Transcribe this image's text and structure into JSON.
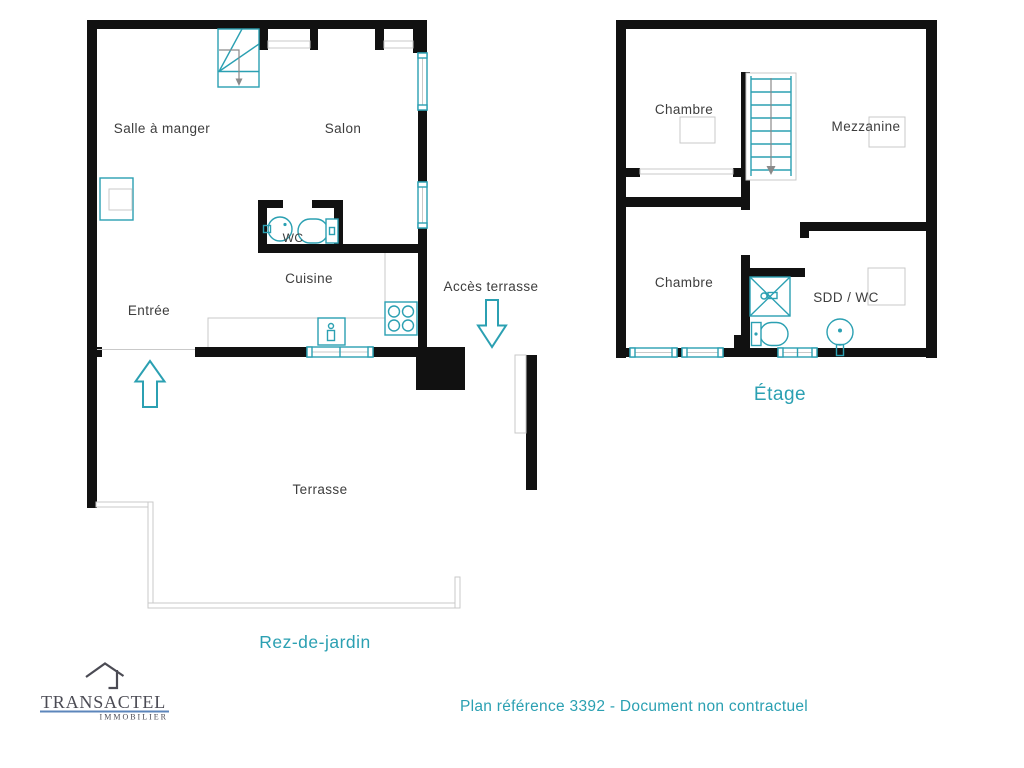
{
  "floors": {
    "ground": {
      "label": "Rez-de-jardin",
      "rooms": {
        "dining": "Salle à manger",
        "living": "Salon",
        "wc": "WC",
        "kitchen": "Cuisine",
        "entry": "Entrée",
        "terrace_access": "Accès terrasse",
        "terrace": "Terrasse"
      }
    },
    "upper": {
      "label": "Étage",
      "rooms": {
        "bedroom_top": "Chambre",
        "mezzanine": "Mezzanine",
        "bedroom_bottom": "Chambre",
        "shower_wc": "SDD / WC"
      }
    }
  },
  "footer": {
    "reference": "Plan référence 3392 - Document non contractuel"
  },
  "branding": {
    "company": "TRANSACTEL",
    "tagline": "IMMOBILIER",
    "logo_icon": "house-icon"
  },
  "colors": {
    "accent_teal": "#2BA0B2",
    "wall_black": "#111111",
    "line_gray": "#c9c9c9",
    "stair_gray": "#8a8a8a",
    "label_dark": "#3d3d3d",
    "logo_slate": "#4b4b54",
    "logo_blue": "#5c86bb",
    "background": "#ffffff"
  }
}
